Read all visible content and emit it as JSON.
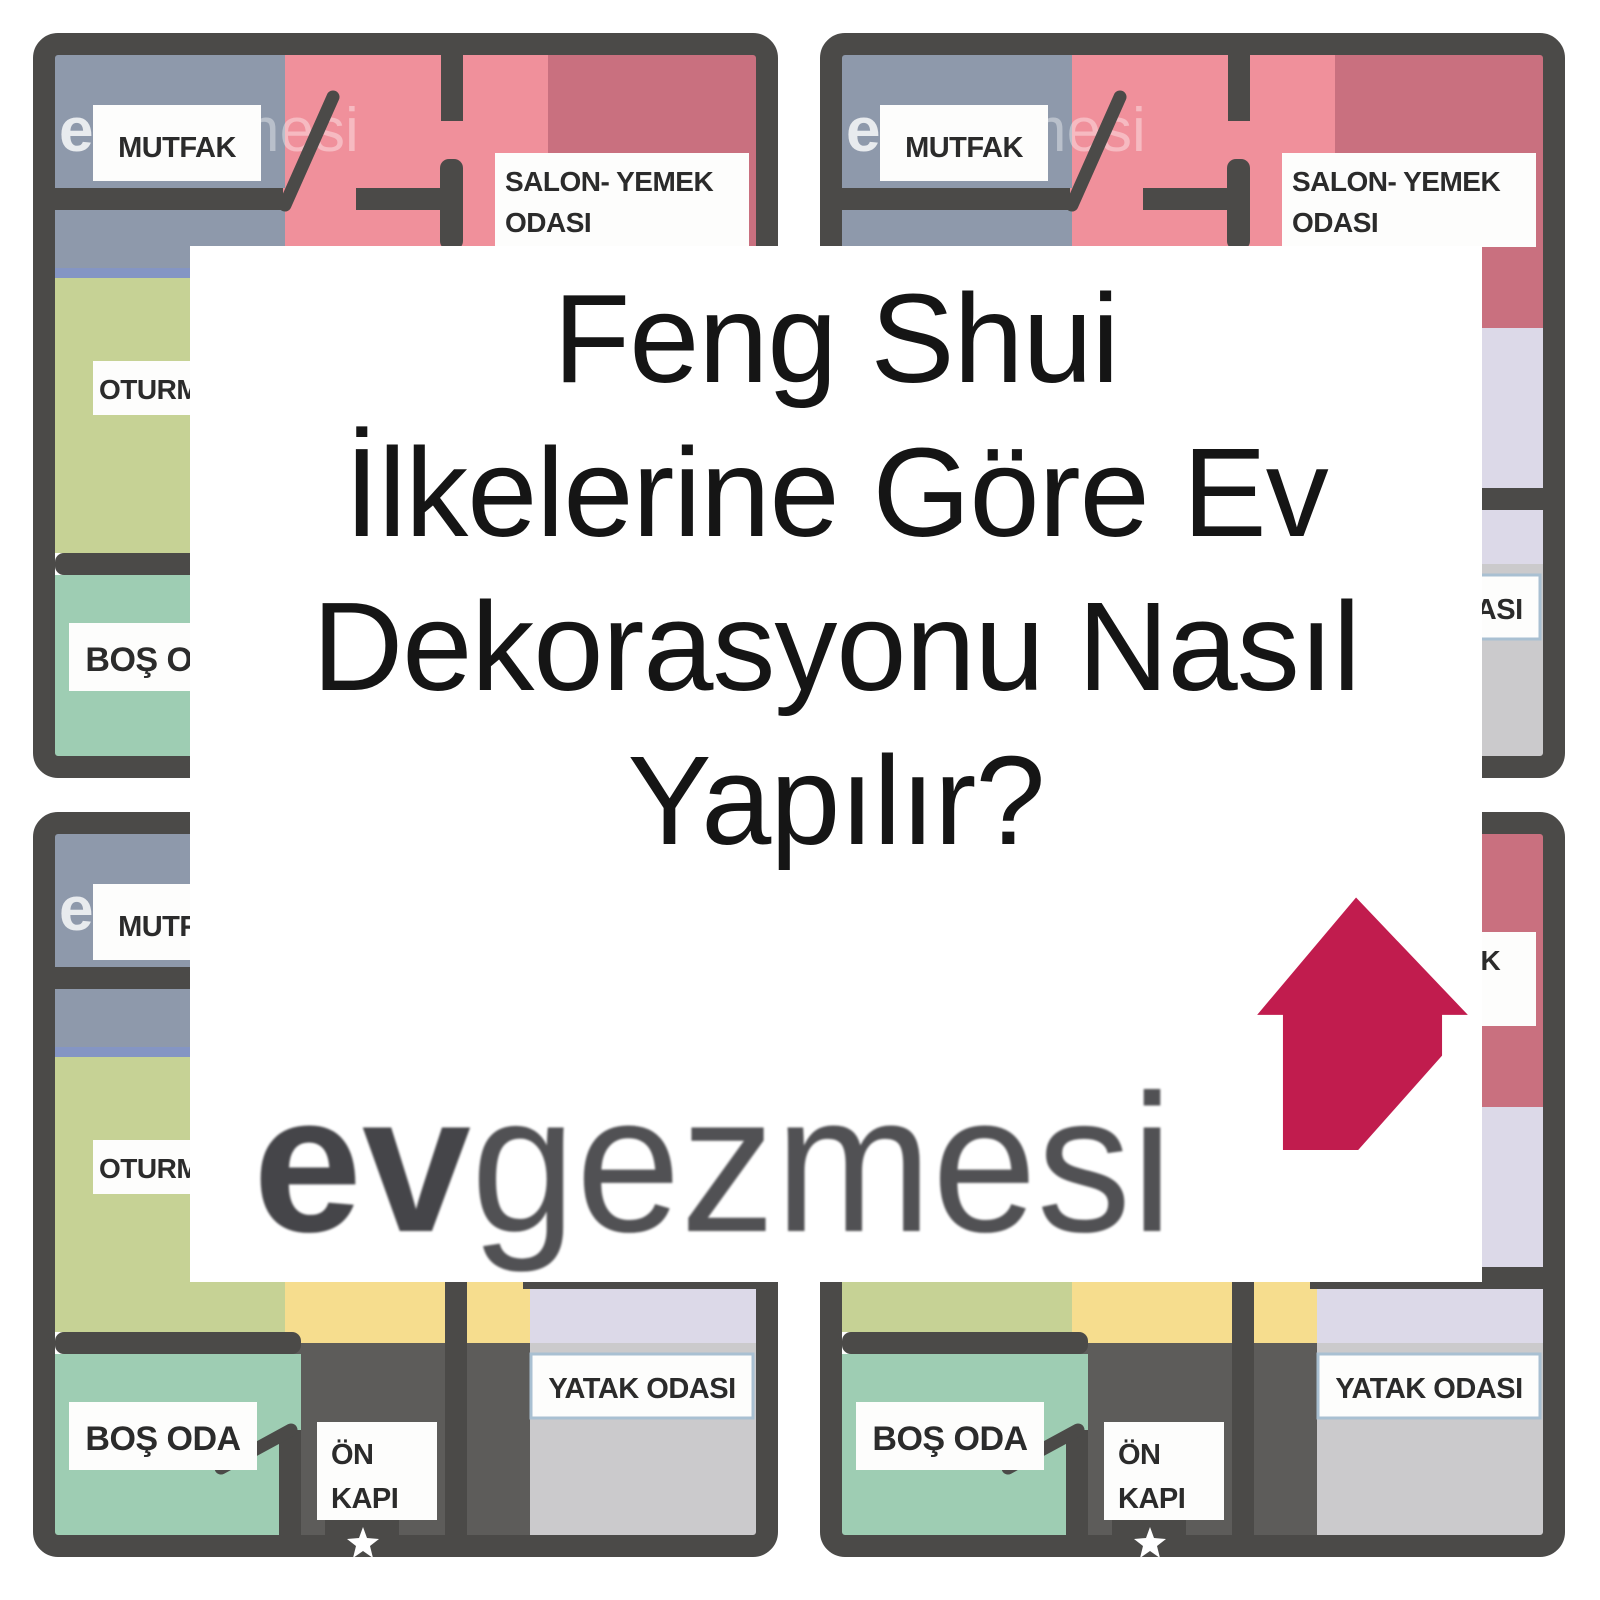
{
  "card": {
    "title_lines": [
      "Feng Shui",
      "İlkelerine Göre Ev",
      "Dekorasyonu Nasıl",
      "Yapılır?"
    ],
    "logo": {
      "bold": "ev",
      "rest": "gezmesi",
      "icon": "house-arrow",
      "icon_color": "#c11c4e",
      "bold_color": "#454549",
      "rest_color": "#515154"
    }
  },
  "floorplan": {
    "wall_color": "#4b4a48",
    "window_color": "#8495c4",
    "label_bg": "#fdfdfc",
    "label_text_color": "#2b2b2b",
    "watermark": {
      "bold": "ev",
      "rest": "gezmesi"
    },
    "rooms": {
      "kitchen": {
        "label": "MUTFAK",
        "color": "#8e99ab"
      },
      "living_dining": {
        "label_line1": "SALON- YEMEK",
        "label_line2": "ODASI",
        "color": "#f0909b"
      },
      "living_dining_dark": {
        "color": "#c9707f"
      },
      "sitting": {
        "label": "OTURMA ODASI",
        "color": "#c6d295"
      },
      "empty": {
        "label": "BOŞ ODA",
        "color": "#9ecdb3"
      },
      "entry": {
        "label_line1": "ÖN",
        "label_line2": "KAPI",
        "color": "#5d5c5a"
      },
      "bedroom": {
        "label": "YATAK ODASI",
        "color": "#cbcacc",
        "label_border": "#a9c0d2"
      },
      "hallway": {
        "color": "#f6dd8e"
      },
      "side_rooms": {
        "color": "#dcd9e8"
      }
    }
  }
}
